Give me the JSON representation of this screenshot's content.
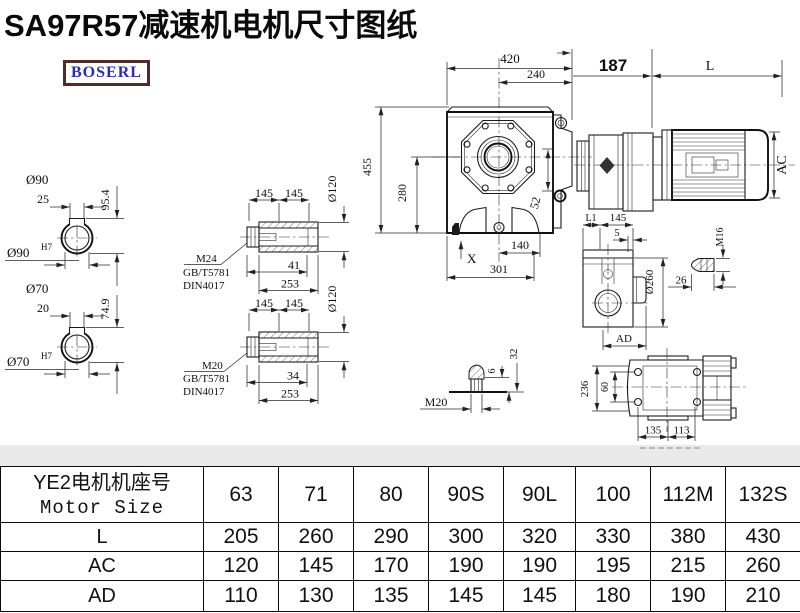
{
  "title": "SA97R57减速机电机尺寸图纸",
  "logo": "BOSERL",
  "drawing": {
    "front": {
      "w": "420",
      "w2": "240",
      "h": "455",
      "h2": "280",
      "d52": "52",
      "d140": "140",
      "d301": "301",
      "x": "X"
    },
    "motor": {
      "d187": "187",
      "l": "L",
      "ac": "AC"
    },
    "shaft_a": {
      "dia": "Ø90",
      "key": "25",
      "depth": "95.4",
      "bore": "Ø90",
      "fit": "H7"
    },
    "shaft_b": {
      "dia": "Ø70",
      "key": "20",
      "depth": "74.9",
      "bore": "Ø70",
      "fit": "H7"
    },
    "bush_a": {
      "s1": "145",
      "s2": "145",
      "dia": "Ø120",
      "bolt": "M24",
      "std1": "GB/T5781",
      "std2": "DIN4017",
      "len": "41",
      "total": "253"
    },
    "bush_b": {
      "s1": "145",
      "s2": "145",
      "dia": "Ø120",
      "bolt": "M20",
      "std1": "GB/T5781",
      "std2": "DIN4017",
      "len": "34",
      "total": "253"
    },
    "side": {
      "l1": "L1",
      "s145": "145",
      "t5": "5",
      "dia": "Ø260",
      "ad": "AD"
    },
    "m16": {
      "label": "M16",
      "len": "26"
    },
    "m20": {
      "label": "M20",
      "d6": "6",
      "d32": "32"
    },
    "bottom": {
      "h236": "236",
      "h60": "60",
      "w135": "135",
      "w113": "113"
    }
  },
  "table": {
    "header_line1": "YE2电机机座号",
    "header_line2": "Motor Size",
    "sizes": [
      "63",
      "71",
      "80",
      "90S",
      "90L",
      "100",
      "112M",
      "132S"
    ],
    "rows": [
      {
        "label": "L",
        "values": [
          "205",
          "260",
          "290",
          "300",
          "320",
          "330",
          "380",
          "430"
        ]
      },
      {
        "label": "AC",
        "values": [
          "120",
          "145",
          "170",
          "190",
          "190",
          "195",
          "215",
          "260"
        ]
      },
      {
        "label": "AD",
        "values": [
          "110",
          "130",
          "135",
          "145",
          "145",
          "180",
          "190",
          "210"
        ]
      }
    ]
  }
}
